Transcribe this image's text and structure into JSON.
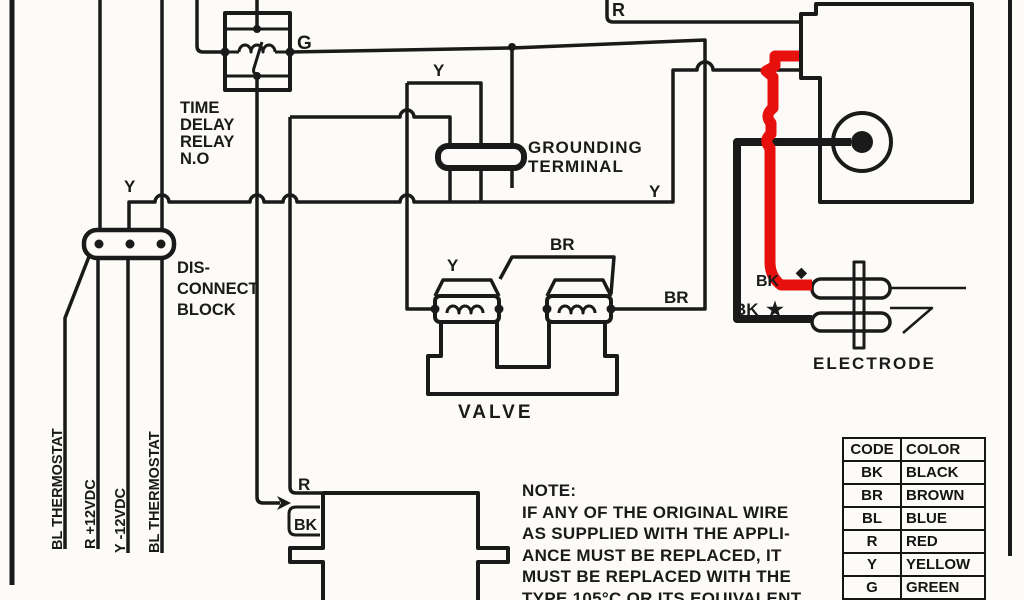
{
  "colors": {
    "line": "#1a1a1a",
    "highlight_wire": "#e8100c",
    "background": "#fcfbf8"
  },
  "labels": {
    "g_wire": "G",
    "relay_line1": "TIME",
    "relay_line2": "DELAY",
    "relay_line3": "RELAY",
    "relay_line4": "N.O",
    "grounding_line1": "GROUNDING",
    "grounding_line2": "TERMINAL",
    "disconnect_line1": "DIS-",
    "disconnect_line2": "CONNECT",
    "disconnect_line3": "BLOCK",
    "y_bracket": "Y",
    "y_block": "Y",
    "y_right": "Y",
    "y_valve": "Y",
    "br_top": "BR",
    "br_right": "BR",
    "r_top": "R",
    "r_box": "R",
    "bk_box": "BK",
    "bk_diamond": "BK",
    "diamond_mark": "◆",
    "bk_star": "BK",
    "star_mark": "★",
    "valve": "VALVE",
    "electrode": "ELECTRODE",
    "thermostat_1": "BL THERMOSTAT",
    "thermostat_2": "R +12VDC",
    "thermostat_3": "Y -12VDC",
    "thermostat_4": "BL THERMOSTAT"
  },
  "note": {
    "heading": "NOTE:",
    "lines": [
      "IF ANY OF THE ORIGINAL WIRE",
      "AS SUPPLIED WITH THE APPLI-",
      "ANCE MUST BE REPLACED, IT",
      "MUST BE REPLACED WITH THE",
      "TYPE 105°C OR ITS EQUIVALENT"
    ]
  },
  "legend": {
    "headers": {
      "code": "CODE",
      "color": "COLOR"
    },
    "rows": [
      {
        "code": "BK",
        "color": "BLACK"
      },
      {
        "code": "BR",
        "color": "BROWN"
      },
      {
        "code": "BL",
        "color": "BLUE"
      },
      {
        "code": "R",
        "color": "RED"
      },
      {
        "code": "Y",
        "color": "YELLOW"
      },
      {
        "code": "G",
        "color": "GREEN"
      }
    ]
  }
}
